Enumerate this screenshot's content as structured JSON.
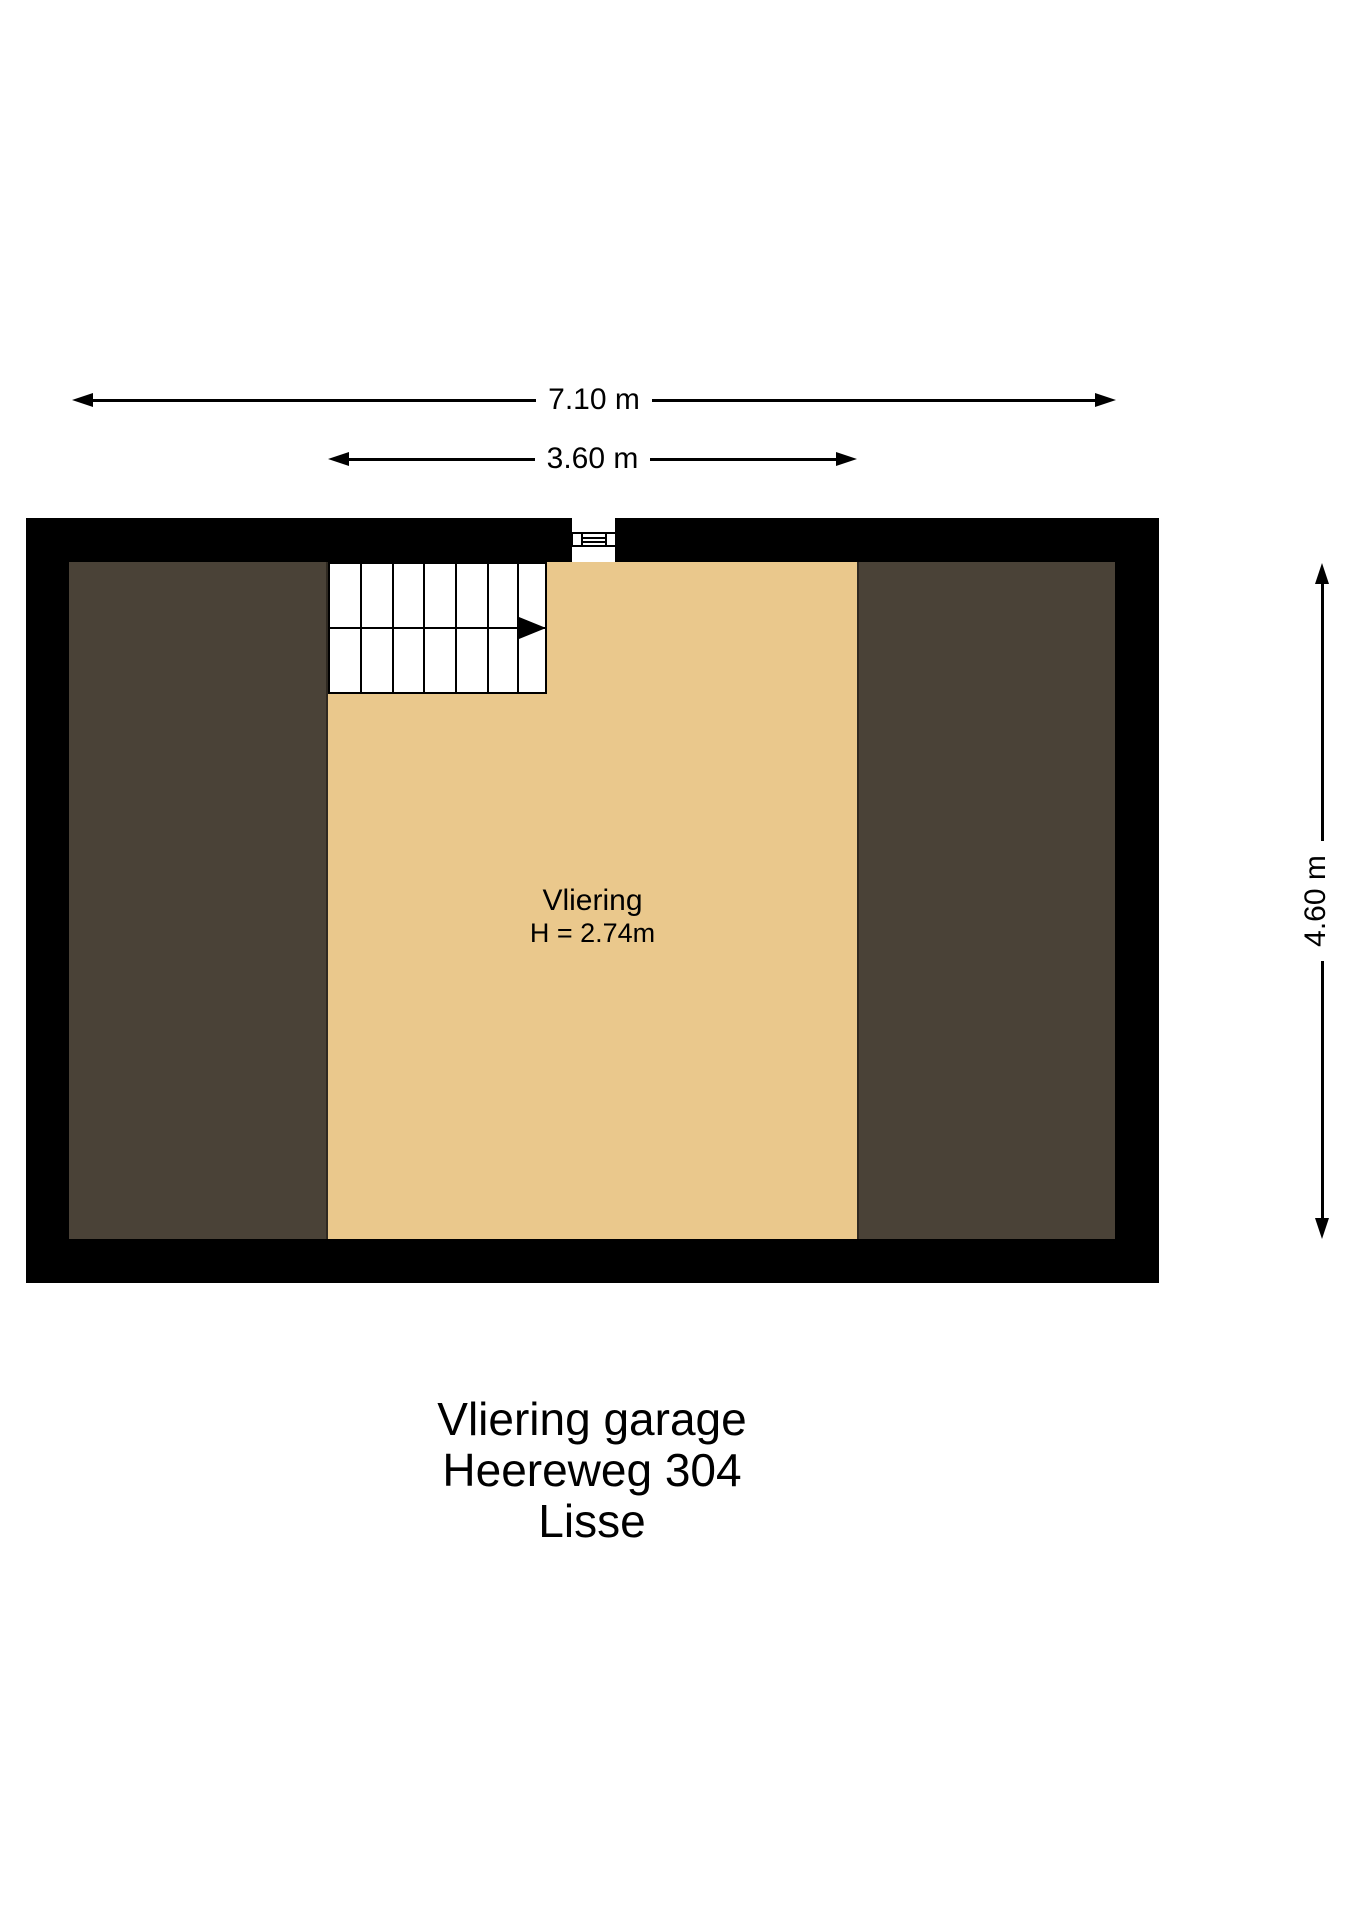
{
  "dimensions": {
    "outer_width": {
      "label": "7.10 m"
    },
    "inner_width": {
      "label": "3.60 m"
    },
    "side_height": {
      "label": "4.60 m"
    }
  },
  "room": {
    "name": "Vliering",
    "height_note": "H = 2.74m"
  },
  "title": {
    "line1": "Vliering garage",
    "line2": "Heereweg 304",
    "line3": "Lisse"
  },
  "icons": {
    "stairs_direction": "right-arrow",
    "wall_opening": "hatch-ladder"
  },
  "colors": {
    "wall": "#000000",
    "side_floor": "#4a4237",
    "vliering_floor": "#eac88c",
    "line": "#000000"
  }
}
